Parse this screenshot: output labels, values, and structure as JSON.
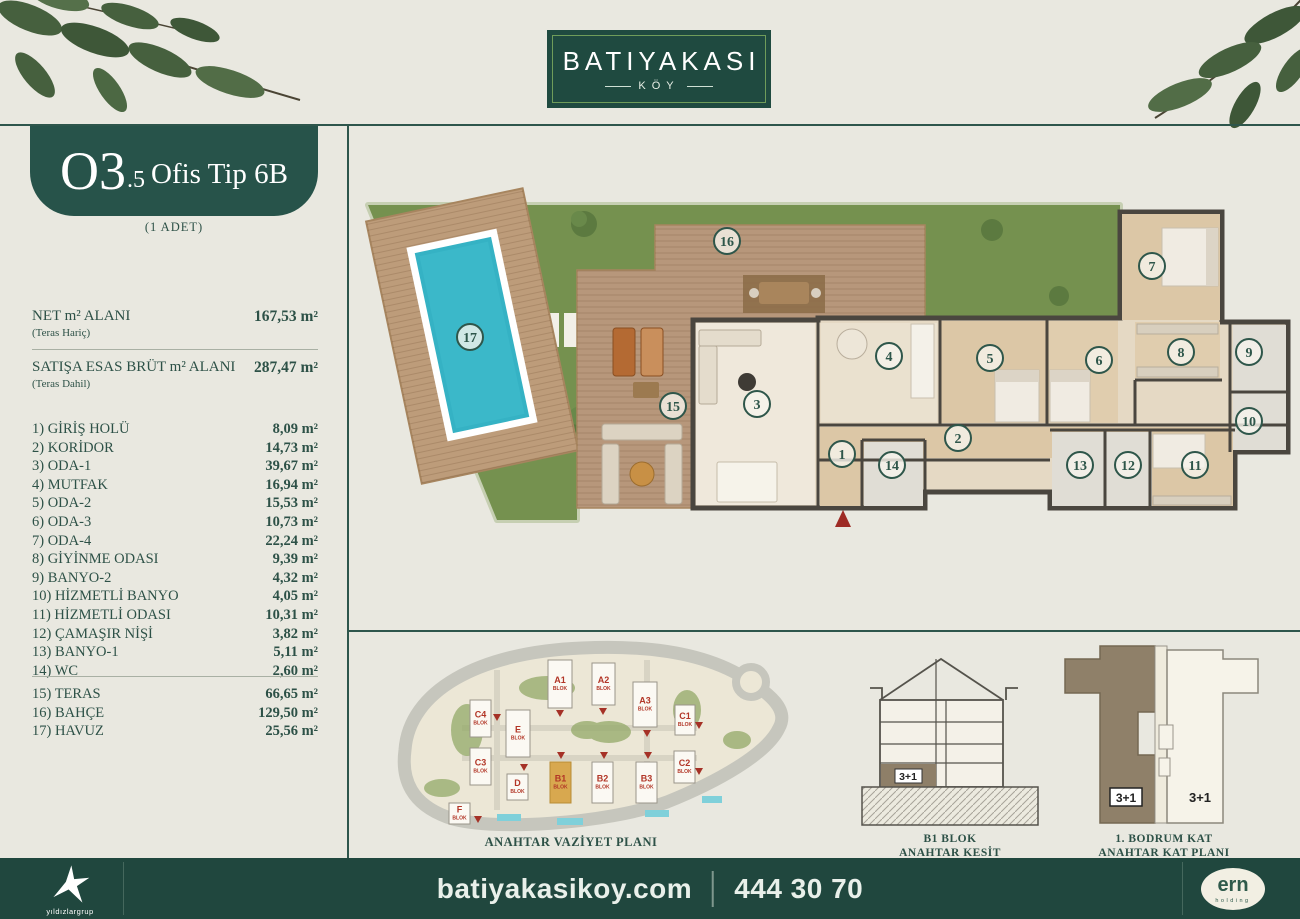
{
  "header": {
    "brand": "BATIYAKASI",
    "brand_sub": "KÖY"
  },
  "unit": {
    "code_big": "O3",
    "code_small": ".5",
    "name": "Ofis Tip 6B",
    "count_note": "(1 ADET)"
  },
  "areas": {
    "net_label": "NET m² ALANI",
    "net_sub": "(Teras Hariç)",
    "net_value": "167,53 m²",
    "gross_label": "SATIŞA ESAS BRÜT m² ALANI",
    "gross_sub": "(Teras Dahil)",
    "gross_value": "287,47 m²"
  },
  "rooms": [
    {
      "no": "1)",
      "name": "GİRİŞ HOLÜ",
      "value": "8,09 m²"
    },
    {
      "no": "2)",
      "name": "KORİDOR",
      "value": "14,73 m²"
    },
    {
      "no": "3)",
      "name": "ODA-1",
      "value": "39,67 m²"
    },
    {
      "no": "4)",
      "name": "MUTFAK",
      "value": "16,94 m²"
    },
    {
      "no": "5)",
      "name": "ODA-2",
      "value": "15,53 m²"
    },
    {
      "no": "6)",
      "name": "ODA-3",
      "value": "10,73 m²"
    },
    {
      "no": "7)",
      "name": "ODA-4",
      "value": "22,24 m²"
    },
    {
      "no": "8)",
      "name": "GİYİNME ODASI",
      "value": "9,39 m²"
    },
    {
      "no": "9)",
      "name": "BANYO-2",
      "value": "4,32 m²"
    },
    {
      "no": "10)",
      "name": "HİZMETLİ BANYO",
      "value": "4,05 m²"
    },
    {
      "no": "11)",
      "name": "HİZMETLİ ODASI",
      "value": "10,31 m²"
    },
    {
      "no": "12)",
      "name": "ÇAMAŞIR NİŞİ",
      "value": "3,82 m²"
    },
    {
      "no": "13)",
      "name": "BANYO-1",
      "value": "5,11 m²"
    },
    {
      "no": "14)",
      "name": "WC",
      "value": "2,60 m²"
    }
  ],
  "outdoor": [
    {
      "no": "15)",
      "name": "TERAS",
      "value": "66,65 m²"
    },
    {
      "no": "16)",
      "name": "BAHÇE",
      "value": "129,50 m²"
    },
    {
      "no": "17)",
      "name": "HAVUZ",
      "value": "25,56 m²"
    }
  ],
  "floorplan": {
    "markers": [
      {
        "n": "1",
        "x": 495,
        "y": 330
      },
      {
        "n": "2",
        "x": 611,
        "y": 314
      },
      {
        "n": "3",
        "x": 410,
        "y": 280
      },
      {
        "n": "4",
        "x": 542,
        "y": 232
      },
      {
        "n": "5",
        "x": 643,
        "y": 234
      },
      {
        "n": "6",
        "x": 752,
        "y": 236
      },
      {
        "n": "7",
        "x": 805,
        "y": 142
      },
      {
        "n": "8",
        "x": 834,
        "y": 228
      },
      {
        "n": "9",
        "x": 902,
        "y": 228
      },
      {
        "n": "10",
        "x": 902,
        "y": 297
      },
      {
        "n": "11",
        "x": 848,
        "y": 341
      },
      {
        "n": "12",
        "x": 781,
        "y": 341
      },
      {
        "n": "13",
        "x": 733,
        "y": 341
      },
      {
        "n": "14",
        "x": 545,
        "y": 341
      },
      {
        "n": "15",
        "x": 326,
        "y": 282
      },
      {
        "n": "16",
        "x": 380,
        "y": 117
      },
      {
        "n": "17",
        "x": 123,
        "y": 213
      }
    ]
  },
  "siteplan": {
    "caption": "ANAHTAR VAZİYET PLANI",
    "blok_word": "BLOK",
    "blocks": [
      {
        "label": "A1",
        "x": 201,
        "y": 30,
        "w": 24,
        "h": 48,
        "highlight": false
      },
      {
        "label": "A2",
        "x": 245,
        "y": 33,
        "w": 23,
        "h": 42,
        "highlight": false
      },
      {
        "label": "A3",
        "x": 286,
        "y": 52,
        "w": 24,
        "h": 45,
        "highlight": false
      },
      {
        "label": "C1",
        "x": 328,
        "y": 75,
        "w": 20,
        "h": 30,
        "highlight": false
      },
      {
        "label": "C4",
        "x": 123,
        "y": 70,
        "w": 21,
        "h": 37,
        "highlight": false
      },
      {
        "label": "E",
        "x": 159,
        "y": 80,
        "w": 24,
        "h": 47,
        "highlight": false
      },
      {
        "label": "C3",
        "x": 123,
        "y": 118,
        "w": 21,
        "h": 37,
        "highlight": false
      },
      {
        "label": "D",
        "x": 160,
        "y": 144,
        "w": 21,
        "h": 26,
        "highlight": false
      },
      {
        "label": "B1",
        "x": 203,
        "y": 132,
        "w": 21,
        "h": 41,
        "highlight": true
      },
      {
        "label": "B2",
        "x": 245,
        "y": 132,
        "w": 21,
        "h": 41,
        "highlight": false
      },
      {
        "label": "B3",
        "x": 289,
        "y": 132,
        "w": 21,
        "h": 41,
        "highlight": false
      },
      {
        "label": "C2",
        "x": 327,
        "y": 121,
        "w": 21,
        "h": 32,
        "highlight": false
      },
      {
        "label": "F",
        "x": 102,
        "y": 173,
        "w": 21,
        "h": 21,
        "highlight": false
      }
    ],
    "triangles": [
      {
        "x": 213,
        "y": 84
      },
      {
        "x": 256,
        "y": 82
      },
      {
        "x": 300,
        "y": 104
      },
      {
        "x": 150,
        "y": 88
      },
      {
        "x": 214,
        "y": 126
      },
      {
        "x": 257,
        "y": 126
      },
      {
        "x": 301,
        "y": 126
      },
      {
        "x": 352,
        "y": 96
      },
      {
        "x": 352,
        "y": 142
      },
      {
        "x": 177,
        "y": 138
      },
      {
        "x": 131,
        "y": 190
      }
    ]
  },
  "kesit": {
    "unit_label": "3+1",
    "caption1": "B1 BLOK",
    "caption2": "ANAHTAR KESİT"
  },
  "katplan": {
    "left_label": "3+1",
    "right_label": "3+1",
    "caption1": "1. BODRUM KAT",
    "caption2": "ANAHTAR KAT PLANI"
  },
  "footer": {
    "website": "batiyakasikoy.com",
    "phone": "444 30 70",
    "left_logo_text": "yıldızlargrup",
    "right_logo_line1": "ern",
    "right_logo_line2": "holding"
  },
  "colors": {
    "brand_dark": "#1F4A40",
    "text_green": "#2D5147",
    "accent_red": "#A8372B",
    "b1_gold": "#D8A84F",
    "pool_blue": "#35B2C4",
    "grass_green": "#75914F",
    "deck_wood": "#B7977B"
  }
}
